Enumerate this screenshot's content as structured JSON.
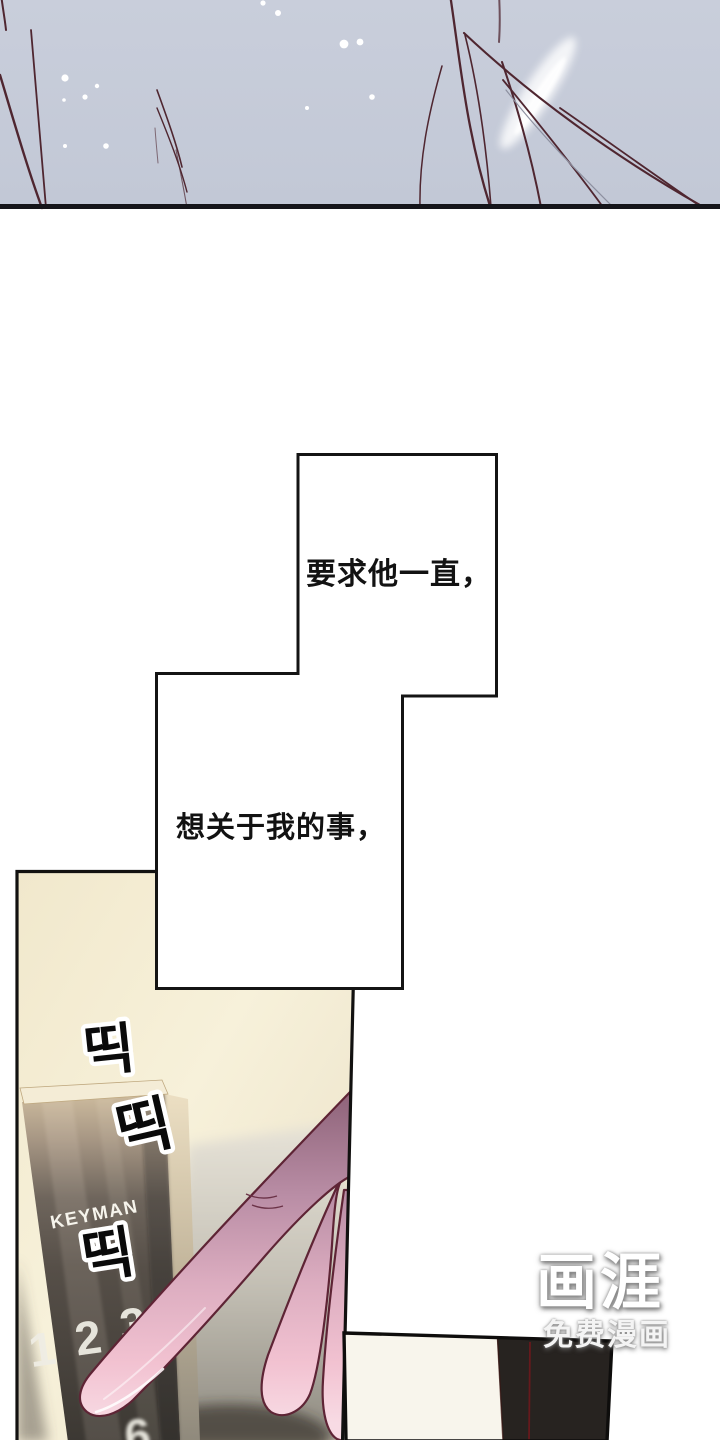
{
  "comic": {
    "speech_bubbles": [
      {
        "text": "要求他一直，"
      },
      {
        "text": "想关于我的事，"
      }
    ],
    "sfx_clicks": [
      "띡",
      "띡",
      "띡"
    ],
    "door_lock": {
      "brand": "KEYMAN",
      "keypad_digits_visible": [
        "1",
        "2",
        "3"
      ],
      "keypad_digit_partial": "6"
    }
  },
  "watermark": {
    "logo": "画涯",
    "tagline": "免费漫画"
  },
  "colors": {
    "top_panel_bg": "#c6ccd9",
    "hair_strand": "#4f2630",
    "panel_border": "#121110",
    "door_wall_cream": "#f5efd8",
    "keypad_dark": "#4e4842",
    "finger_pink": "#f2c2d1",
    "finger_shadow_mauve": "#8d6278",
    "bottom_panel_dark": "#272320",
    "door_seam_red": "#66191c"
  }
}
